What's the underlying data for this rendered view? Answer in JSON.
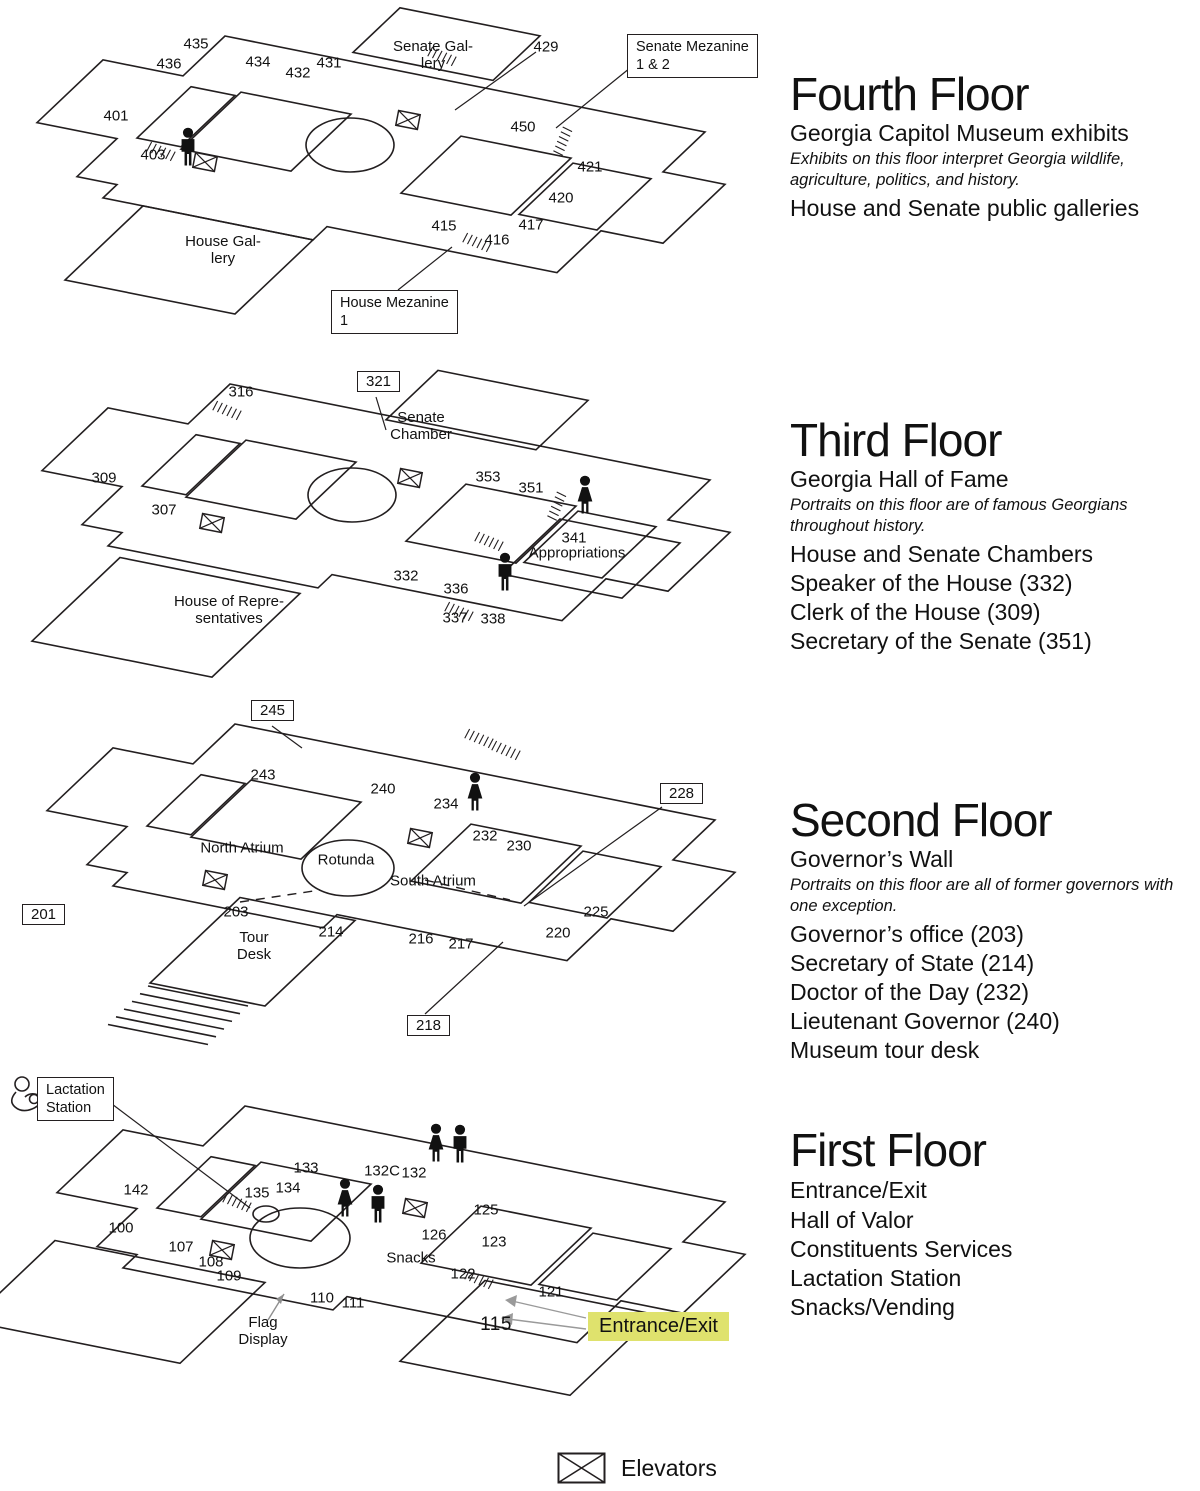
{
  "title": "Georgia Capitol Museum floor maps",
  "colors": {
    "line": "#231f20",
    "highlight": "#dfe26d",
    "text": "#000000",
    "arrow_gray": "#8f8f8f"
  },
  "icons": {
    "elevator": "rectangle with X",
    "male_restroom": "male figure silhouette",
    "female_restroom": "female figure silhouette",
    "lactation": "mother nursing baby outline",
    "stairs": "hatched steps"
  },
  "legend": {
    "elevator_label": "Elevators"
  },
  "floors": [
    {
      "info": {
        "title": "Fourth Floor",
        "subtitle": "Georgia Capitol Museum exhibits",
        "note": "Exhibits on this floor interpret Georgia wildlife, agriculture, politics, and history.",
        "items": [
          "House and Senate public galleries"
        ]
      },
      "plan": {
        "rooms": [
          "435",
          "436",
          "434",
          "432",
          "431",
          "429",
          "401",
          "403",
          "450",
          "421",
          "420",
          "417",
          "415",
          "416"
        ],
        "areas": [
          "Senate Gal-\nlery",
          "House Gal-\nlery"
        ],
        "callouts": [
          "Senate Mezanine\n1 & 2",
          "House Mezanine\n1"
        ]
      }
    },
    {
      "info": {
        "title": "Third Floor",
        "subtitle": "Georgia Hall of Fame",
        "note": "Portraits on this floor are of famous Georgians throughout history.",
        "items": [
          "House and Senate Chambers",
          "Speaker of the House (332)",
          "Clerk of the House (309)",
          "Secretary of the Senate (351)"
        ]
      },
      "plan": {
        "rooms": [
          "316",
          "309",
          "307",
          "353",
          "351",
          "341",
          "332",
          "336",
          "337",
          "338"
        ],
        "boxed_rooms": [
          "321"
        ],
        "areas": [
          "Senate\nChamber",
          "Appropriations",
          "House of Repre-\nsentatives"
        ]
      }
    },
    {
      "info": {
        "title": "Second Floor",
        "subtitle": "Governor’s Wall",
        "note": "Portraits on this floor are all of former governors with one exception.",
        "items": [
          "Governor’s office (203)",
          "Secretary of State (214)",
          "Doctor of the Day (232)",
          "Lieutenant Governor (240)",
          "Museum tour desk"
        ]
      },
      "plan": {
        "rooms": [
          "243",
          "240",
          "234",
          "232",
          "230",
          "225",
          "220",
          "217",
          "216",
          "214",
          "203"
        ],
        "boxed_rooms": [
          "245",
          "228",
          "201",
          "218"
        ],
        "areas": [
          "North Atrium",
          "Rotunda",
          "South Atrium",
          "Tour\nDesk"
        ]
      }
    },
    {
      "info": {
        "title": "First Floor",
        "items": [
          "Entrance/Exit",
          "Hall of Valor",
          "Constituents Services",
          "Lactation Station",
          "Snacks/Vending"
        ]
      },
      "plan": {
        "rooms": [
          "142",
          "133",
          "134",
          "135",
          "132C",
          "132",
          "100",
          "107",
          "108",
          "109",
          "110",
          "111",
          "115",
          "121",
          "122",
          "123",
          "125",
          "126"
        ],
        "areas": [
          "Snacks",
          "Flag\nDisplay"
        ],
        "callouts": [
          "Lactation\nStation"
        ],
        "highlight_label": "Entrance/Exit"
      }
    }
  ]
}
